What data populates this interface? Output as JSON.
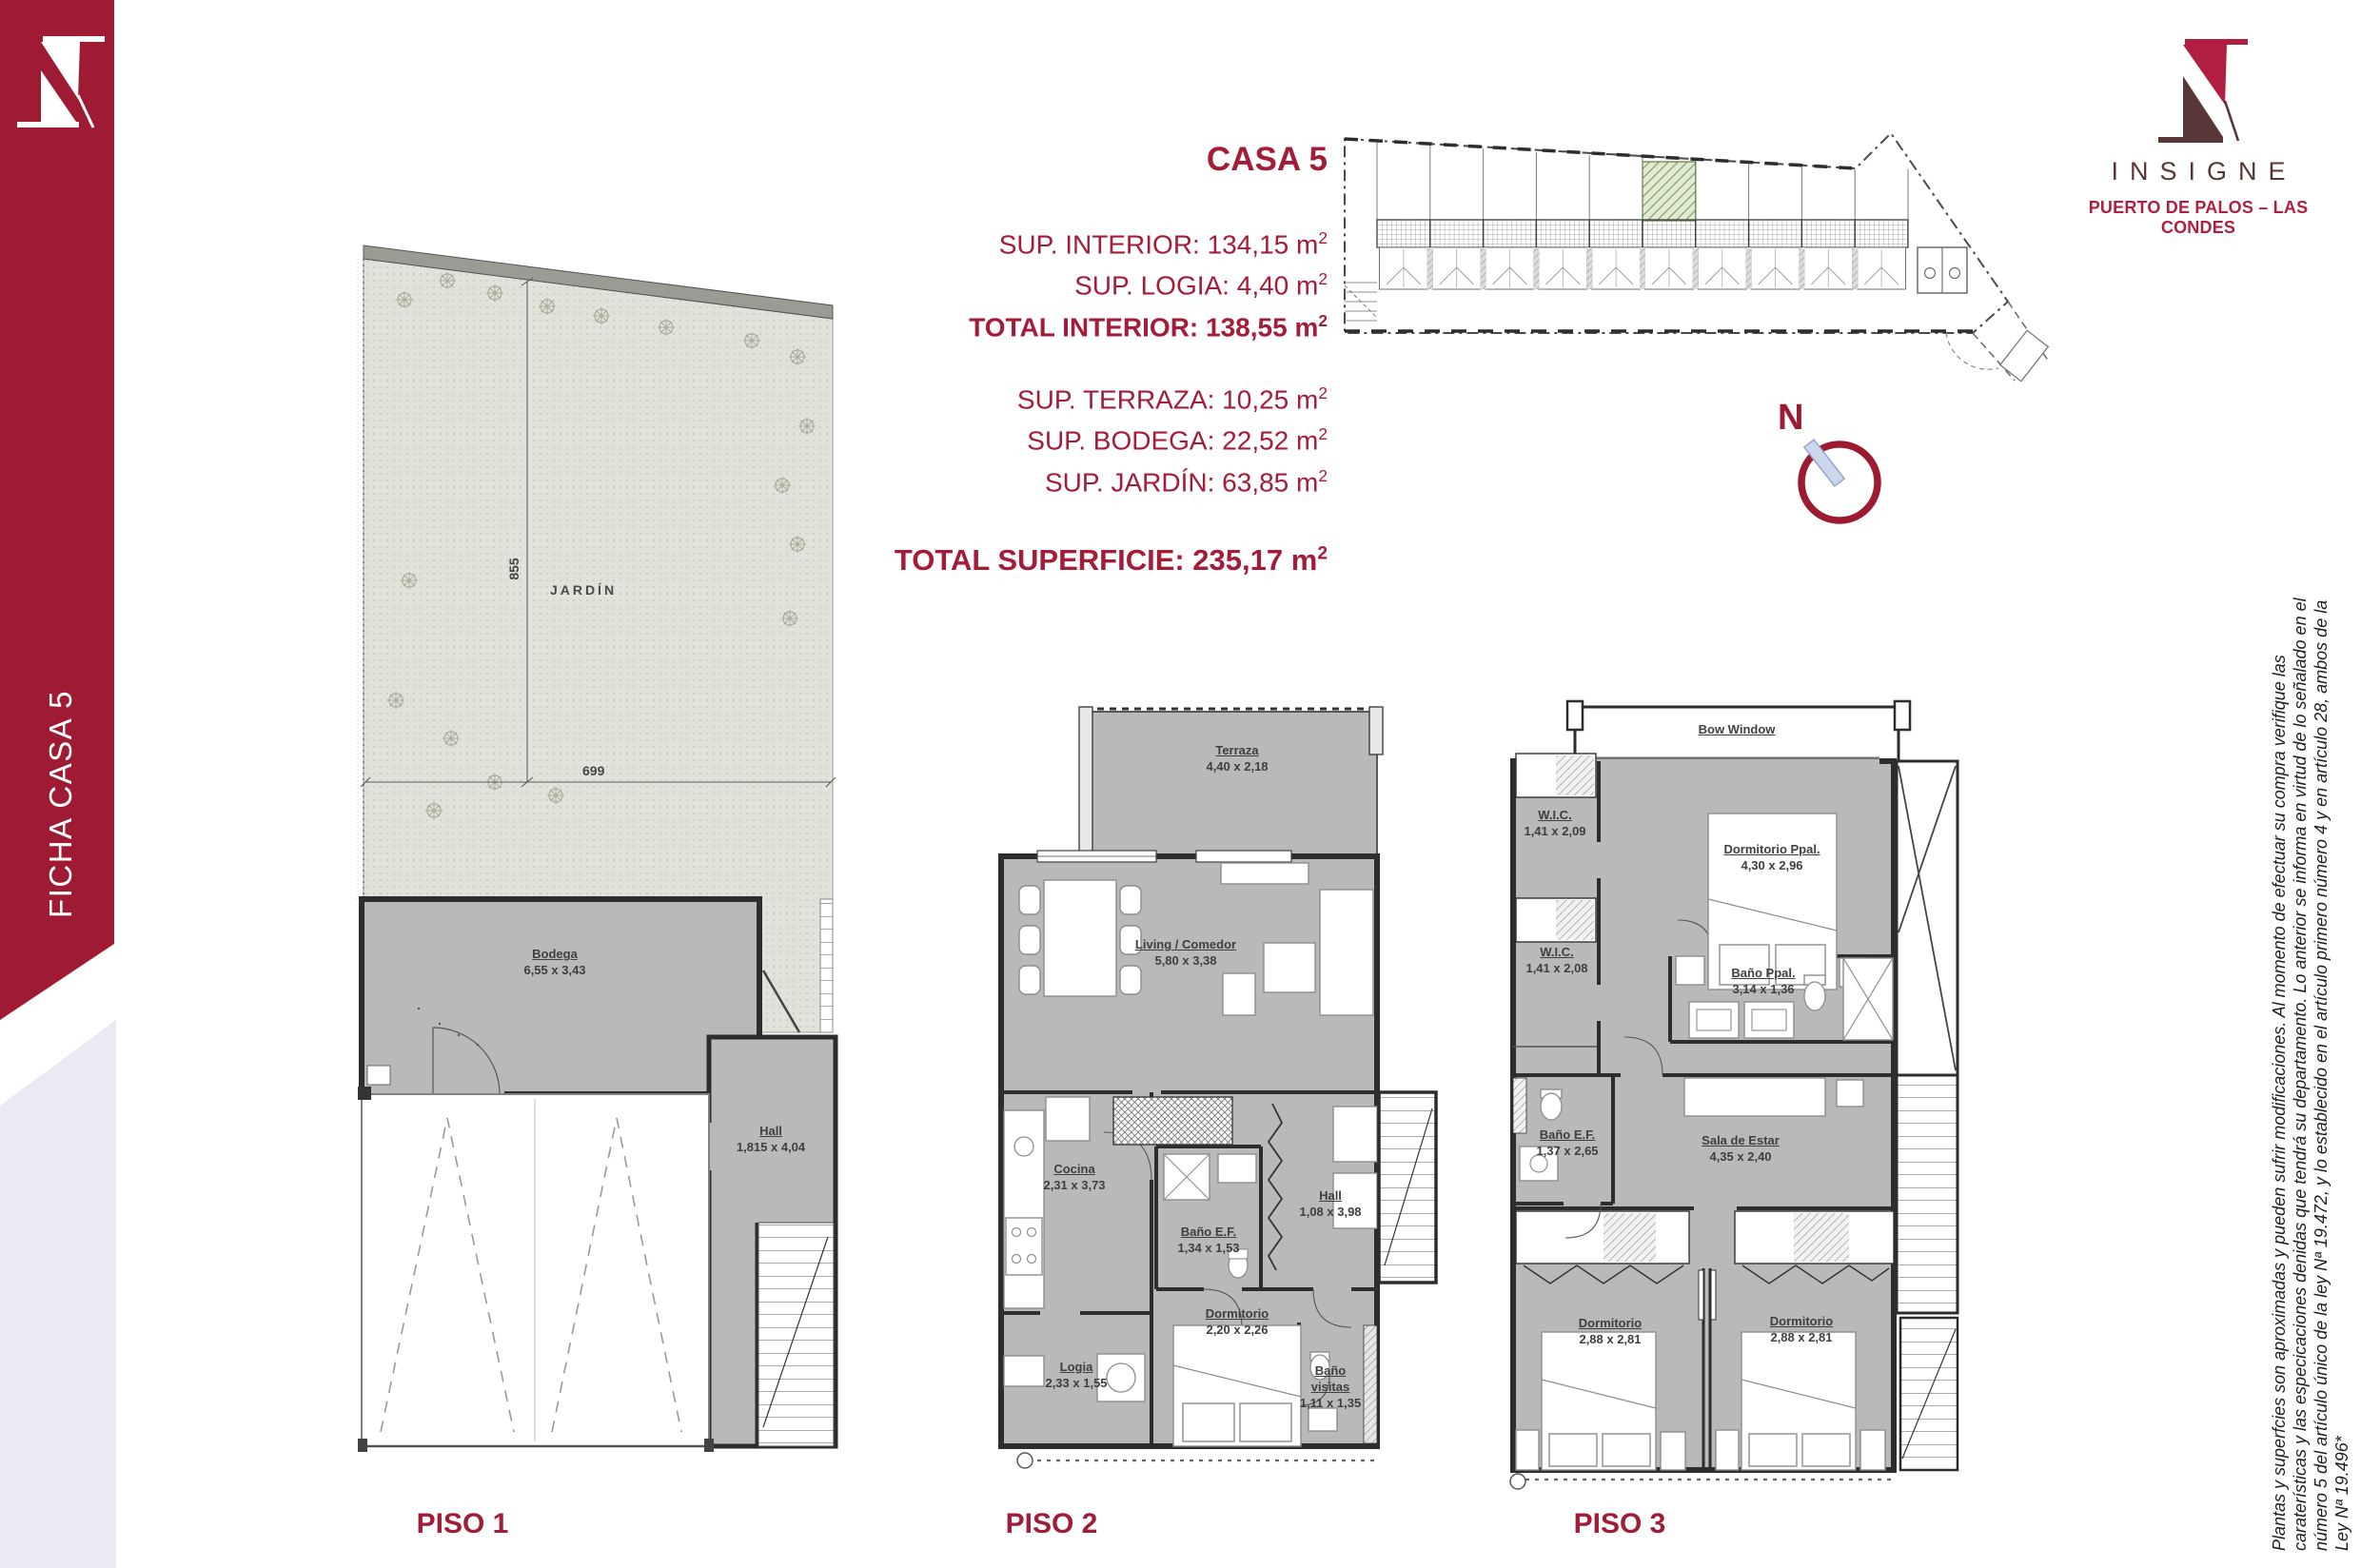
{
  "sidebar": {
    "label": "FICHA CASA 5"
  },
  "brand": {
    "wordmark": "INSIGNE",
    "location": "PUERTO DE PALOS – LAS CONDES"
  },
  "colors": {
    "crimson": "#a01a33",
    "text_red": "#a31c38",
    "brand_red": "#b01f3f",
    "brand_dark": "#573738",
    "plan_gray": "#b9b9b9",
    "garden_green": "#e2e2da",
    "site_green": "#7fa35e",
    "lavender": "#e9eaf3",
    "needle_blue": "#ccd7ee"
  },
  "info": {
    "title": "CASA 5",
    "rows": [
      {
        "text": "SUP. INTERIOR: 134,15 m",
        "sup": "2"
      },
      {
        "text": "SUP. LOGIA: 4,40 m",
        "sup": "2"
      },
      {
        "text": "TOTAL INTERIOR: 138,55 m",
        "sup": "2"
      },
      {
        "text": "SUP. TERRAZA: 10,25 m",
        "sup": "2"
      },
      {
        "text": "SUP. BODEGA: 22,52 m",
        "sup": "2"
      },
      {
        "text": "SUP. JARDÍN: 63,85 m",
        "sup": "2"
      }
    ],
    "total": {
      "text": "TOTAL SUPERFICIE: 235,17 m",
      "sup": "2"
    }
  },
  "north": {
    "label": "N"
  },
  "floors": {
    "piso1": {
      "label": "PISO 1",
      "jardin": "JARDÍN",
      "dim_v": "855",
      "dim_h": "699",
      "bodega": {
        "name": "Bodega",
        "dim": "6,55 x 3,43"
      },
      "hall": {
        "name": "Hall",
        "dim": "1,815 x 4,04"
      }
    },
    "piso2": {
      "label": "PISO 2",
      "terraza": {
        "name": "Terraza",
        "dim": "4,40 x 2,18"
      },
      "living": {
        "name": "Living / Comedor",
        "dim": "5,80 x 3,38"
      },
      "cocina": {
        "name": "Cocina",
        "dim": "2,31 x 3,73"
      },
      "bano_ef": {
        "name": "Baño E.F.",
        "dim": "1,34 x 1,53"
      },
      "hall": {
        "name": "Hall",
        "dim": "1,08 x 3,98"
      },
      "dormitorio": {
        "name": "Dormitorio",
        "dim": "2,20 x 2,26"
      },
      "logia": {
        "name": "Logia",
        "dim": "2,33 x 1,55"
      },
      "bano_visitas": {
        "name": "Baño visitas",
        "dim": "1,11 x 1,35"
      }
    },
    "piso3": {
      "label": "PISO 3",
      "bow": "Bow Window",
      "wic1": {
        "name": "W.I.C.",
        "dim": "1,41 x 2,09"
      },
      "dorm_ppal": {
        "name": "Dormitorio Ppal.",
        "dim": "4,30 x 2,96"
      },
      "wic2": {
        "name": "W.I.C.",
        "dim": "1,41 x 2,08"
      },
      "bano_ppal": {
        "name": "Baño Ppal.",
        "dim": "3,14 x 1,36"
      },
      "bano_ef": {
        "name": "Baño E.F.",
        "dim": "1,37 x 2,65"
      },
      "sala": {
        "name": "Sala de Estar",
        "dim": "4,35 x 2,40"
      },
      "dorm_a": {
        "name": "Dormitorio",
        "dim": "2,88 x 2,81"
      },
      "dorm_b": {
        "name": "Dormitorio",
        "dim": "2,88 x 2,81"
      }
    }
  },
  "disclaimer": {
    "lines": [
      "Plantas y superfcies son aproximadas y pueden sufrir modificaciones. Al momento de efectuar su compra verifique las",
      "caraterísticas y las especicaciones denidas que tendrá su departamento. Lo anterior se informa en virtud de lo señalado en el",
      "número 5 del artículo único de la ley Nª 19.472, y lo establecido en el artículo primero número 4 y en artículo 28, ambos de la",
      "Ley Nª 19.496*"
    ]
  }
}
